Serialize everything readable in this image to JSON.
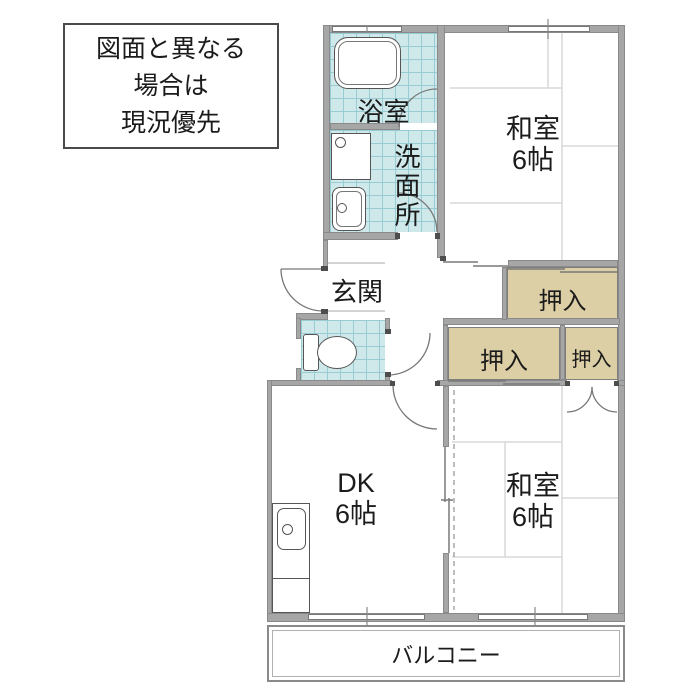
{
  "notice_box": {
    "lines": [
      "図面と異なる",
      "場合は",
      "現況優先"
    ]
  },
  "rooms": {
    "bathroom": {
      "label": "浴室"
    },
    "washroom": {
      "label": "洗面所"
    },
    "genkan": {
      "label": "玄関"
    },
    "washitsu_top": {
      "label": "和室",
      "size": "6帖"
    },
    "washitsu_bottom": {
      "label": "和室",
      "size": "6帖"
    },
    "dk": {
      "label": "DK",
      "size": "6帖"
    },
    "closet_top": {
      "label": "押入"
    },
    "closet_mid_left": {
      "label": "押入"
    },
    "closet_mid_right": {
      "label": "押入"
    },
    "balcony": {
      "label": "バルコニー"
    }
  },
  "colors": {
    "wall": "#a6a6a6",
    "wall_edge": "#8a8a8a",
    "tile": "#cfe9eb",
    "tile_grid": "#97ccd4",
    "closet": "#dccfa6",
    "line": "#666666",
    "tatami": "#d9d9d9",
    "ink": "#1b1b1b"
  }
}
